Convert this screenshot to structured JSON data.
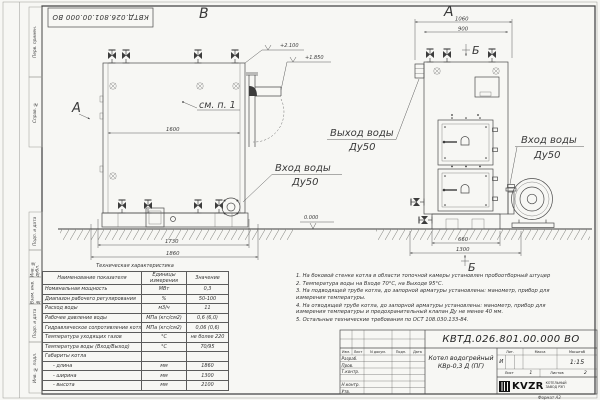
{
  "frame": {
    "top_stamp": "КВТД.026.801.00.000 ВО",
    "side_labels": [
      "Перв. примен.",
      "Справ. №",
      "Подп. и дата",
      "Инв. № дубл.",
      "Взам. инв. №",
      "Подп. и дата",
      "Инв. № подл."
    ],
    "format_label": "Формат А3"
  },
  "drawing": {
    "front_view": {
      "view_label": "В",
      "section_arrow_label": "А",
      "see_note_label": "см. п. 1",
      "dim_inner_width": "1600",
      "dim_support_width": "1730",
      "dim_total_length": "1860",
      "elev_top": "+2.100",
      "elev_outlet": "+1.850",
      "elev_ground": "0.000",
      "inlet_label": "Вход воды",
      "inlet_size": "Ду50"
    },
    "side_view": {
      "view_label": "А",
      "section_label_top": "Б",
      "section_label_bottom": "Б",
      "dim_total_width": "1060",
      "dim_body_width": "900",
      "dim_base_width": "660",
      "dim_full_width": "1300",
      "outlet_label": "Выход воды",
      "outlet_size": "Ду50",
      "inlet_label": "Вход воды",
      "inlet_size": "Ду50"
    }
  },
  "spec_table": {
    "title": "Техническая характеристика",
    "headers": [
      "Наименование показателя",
      "Единицы измерения",
      "Значение"
    ],
    "rows": [
      [
        "Номинальная мощность",
        "МВт",
        "0,3"
      ],
      [
        "Диапазон рабочего регулирования",
        "%",
        "50-100"
      ],
      [
        "Расход воды",
        "м3/ч",
        "11"
      ],
      [
        "Рабочее давление воды",
        "МПа (кгс/см2)",
        "0,6 (6,0)"
      ],
      [
        "Гидравлическое сопротивление котла",
        "МПа (кгс/см2)",
        "0,06 (0,6)"
      ],
      [
        "Температура уходящих газов",
        "°С",
        "не более 220"
      ],
      [
        "Температура воды (Вход/Выход)",
        "°С",
        "70/95"
      ],
      [
        "Габариты котла",
        "",
        ""
      ],
      [
        "- длина",
        "мм",
        "1860"
      ],
      [
        "- ширина",
        "мм",
        "1300"
      ],
      [
        "- высота",
        "мм",
        "2100"
      ]
    ]
  },
  "notes": [
    "1.  На боковой стенке котла в области топочной камеры установлен пробоотборный штуцер",
    "2.  Температура воды на Входе 70°С, на Выходе 95°С.",
    "3.  На подводящей трубе котла, до запорной арматуры установлены: манометр, прибор для измерения температуры.",
    "4.  На отводящей трубе котла, до запорной арматуры установлены: манометр, прибор для измерения температуры и предохранительный клапан Ду не менее 40 мм.",
    "5.  Остальные технические требования по ОСТ 108.030.133-84."
  ],
  "title_block": {
    "designation": "КВТД.026.801.00.000  ВО",
    "product_name": "Котел водогрейный КВр-0,3 Д (ПГ)",
    "rev_headers": [
      "Изм.",
      "Лист",
      "N докум.",
      "Подп.",
      "Дата"
    ],
    "roles": [
      "Разраб.",
      "Пров.",
      "Т.контр.",
      "",
      "Н.контр.",
      "Утв."
    ],
    "lit_label": "Лит.",
    "mass_label": "Масса",
    "scale_label": "Масштаб",
    "lit_value": "И",
    "scale_value": "1:15",
    "sheet_label": "Лист",
    "sheet_value": "1",
    "sheets_label": "Листов",
    "sheets_value": "2",
    "logo_text": "KVZR",
    "company_line1": "КОТЕЛЬНЫЙ",
    "company_line2": "ЗАВОД РЭП"
  }
}
